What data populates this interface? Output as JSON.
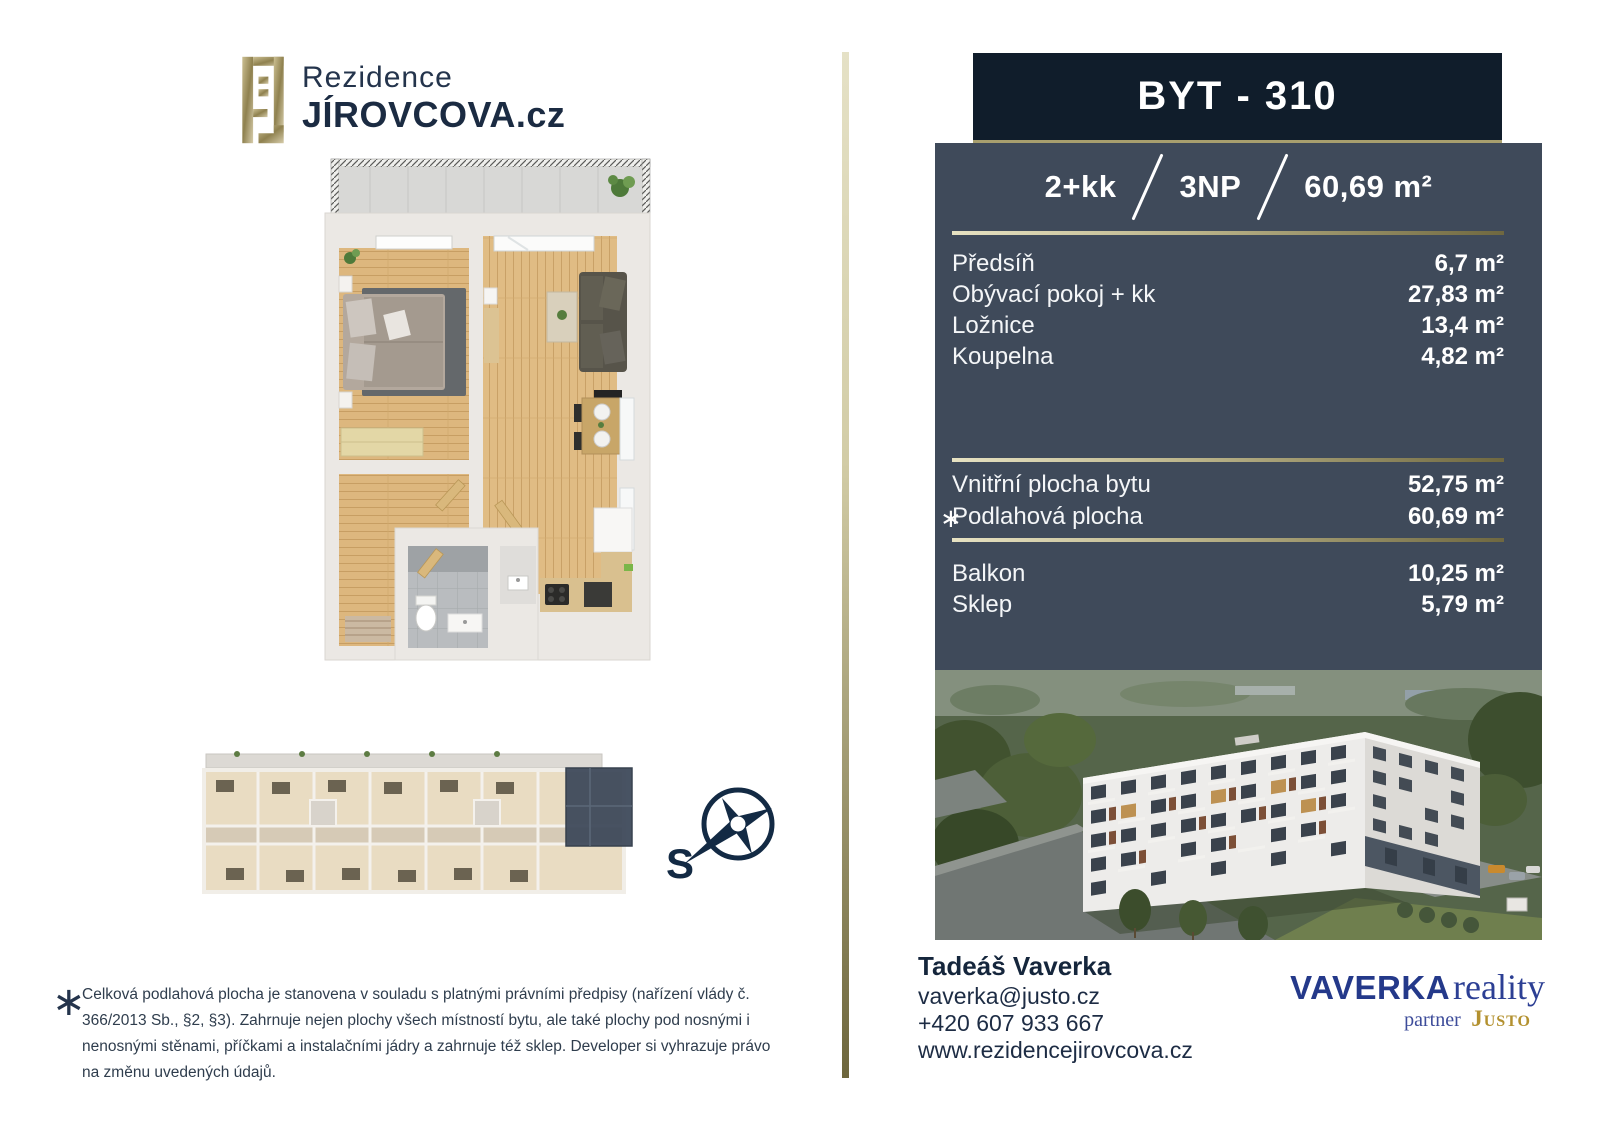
{
  "brand": {
    "line1": "Rezidence",
    "line2": "JÍROVCOVA.cz"
  },
  "unit": {
    "title": "BYT - 310",
    "disposition": "2+kk",
    "floor": "3NP",
    "total_area": "60,69 m²",
    "rooms": [
      {
        "label": "Předsíň",
        "area": "6,7 m²"
      },
      {
        "label": "Obývací pokoj + kk",
        "area": "27,83 m²"
      },
      {
        "label": "Ložnice",
        "area": "13,4 m²"
      },
      {
        "label": "Koupelna",
        "area": "4,82 m²"
      }
    ],
    "summary_marker": "∗",
    "summary": [
      {
        "label": "Vnitřní plocha bytu",
        "area": "52,75 m²"
      },
      {
        "label": "Podlahová plocha",
        "area": "60,69 m²"
      }
    ],
    "extras": [
      {
        "label": "Balkon",
        "area": "10,25 m²"
      },
      {
        "label": "Sklep",
        "area": "5,79 m²"
      }
    ]
  },
  "contact": {
    "name": "Tadeáš Vaverka",
    "email": "vaverka@justo.cz",
    "phone": "+420 607 933 667",
    "website": "www.rezidencejirovcova.cz"
  },
  "partner": {
    "primary": "VAVERKA",
    "secondary": "reality",
    "sub_prefix": "partner",
    "sub_brand": "Justo"
  },
  "compass": {
    "label": "S"
  },
  "footnote": {
    "marker": "∗",
    "lines": [
      "Celková podlahová plocha je stanovena v souladu s platnými právními předpisy (nařízení vlády č.",
      "366/2013 Sb., §2, §3). Zahrnuje nejen plochy všech místností bytu, ale také plochy pod nosnými i",
      "nenosnými stěnami, příčkami a instalačními jádry a zahrnuje též sklep. Developer si vyhrazuje právo",
      "na změnu uvedených údajů."
    ]
  },
  "colors": {
    "header_navy": "#101d2b",
    "panel_slate": "#3f4a5a",
    "gold_accent": "#a89f6e",
    "logo_blue": "#24398a",
    "logo_gold": "#b3912f"
  }
}
